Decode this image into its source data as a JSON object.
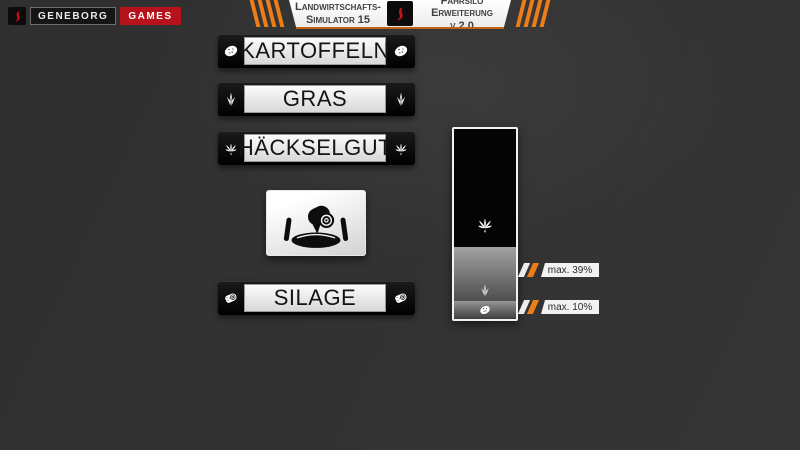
{
  "branding": {
    "studio": "GENEBORG",
    "division": "GAMES"
  },
  "header": {
    "game_title_line1": "Landwirtschafts-",
    "game_title_line2": "Simulator 15",
    "mod_title_line1": "Fahrsilo",
    "mod_title_line2": "Erweiterung v.2.0"
  },
  "colors": {
    "background": "#323232",
    "accent_orange": "#ee7d18",
    "brand_red": "#b5121b",
    "panel_black": "#0a0a0a",
    "label_light": "#ececec"
  },
  "crops": [
    {
      "label": "KARTOFFELN",
      "icon": "potato-icon"
    },
    {
      "label": "GRAS",
      "icon": "grass-icon"
    },
    {
      "label": "HÄCKSELGUT",
      "icon": "chaff-icon"
    },
    {
      "label": "SILAGE",
      "icon": "silage-bale-icon"
    }
  ],
  "silo": {
    "emblem_icon": "bunker-silo-roller-icon",
    "segments": [
      {
        "crop": "HÄCKSELGUT",
        "icon": "chaff-icon",
        "max_percent": 100
      },
      {
        "crop": "GRAS",
        "icon": "grass-icon",
        "max_percent": 39,
        "callout": "max. 39%"
      },
      {
        "crop": "KARTOFFELN",
        "icon": "potato-icon",
        "max_percent": 10,
        "callout": "max. 10%"
      }
    ]
  }
}
